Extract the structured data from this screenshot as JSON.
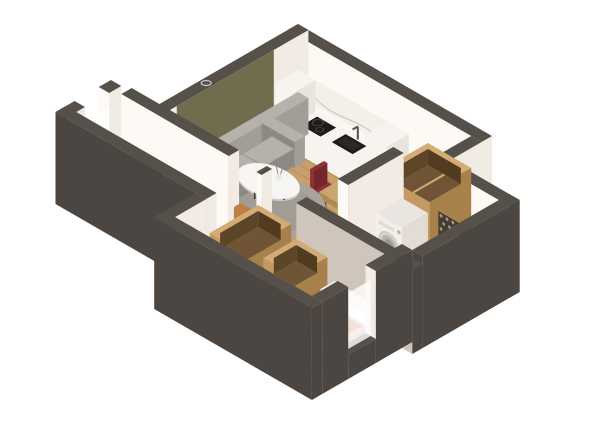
{
  "image": {
    "description": "3D isometric cutaway rendering of a one-bedroom apartment floor plan",
    "view": "isometric",
    "background": "#ffffff"
  },
  "palette": {
    "wallTop": "#56504b",
    "wallOuter": "#4b4641",
    "wallFace": "#f1ebe4",
    "wallFaceBright": "#fdfaf5",
    "wallFaceShade": "#e7dfd5",
    "wallTaupe": "#cfc5ba",
    "olive": "#6f6d4d",
    "oliveShade": "#5d5b40",
    "wood": "#c9a06b",
    "bedroomWood": "#bd9460",
    "plankLine": "rgba(90,60,30,0.18)",
    "hallFloor": "#f4ecdd",
    "bathFloor": "#dfdbd5",
    "tileLine": "rgba(120,110,100,0.25)",
    "rug": "#a8a39d",
    "rugShade": "#948f89",
    "sofa": "#a29e97",
    "sofaLight": "#b6b2ab",
    "sofaShade": "#8d8982",
    "tableWhite": "#f6f5f3",
    "tableEdge": "#cfcac4",
    "legDark": "#3a352f",
    "armchair": "#bf7f44",
    "armchairLight": "#cf9257",
    "armchairDark": "#a86a35",
    "chairRed": "#8e3038",
    "chairRedDark": "#74262d",
    "diningWood": "#cba571",
    "diningWoodSide": "#b08850",
    "cabWood": "#c39a63",
    "cabWoodSide": "#a8804c",
    "cabInterior": "#6f5535",
    "cabRim": "#d3ab75",
    "counter": "#f7f4f0",
    "counterSide": "#eae4dc",
    "appliance": "#1d1c1a",
    "marble": "#f3efe9",
    "marbleVein": "#c9c2b8",
    "mosaic": "#453b31",
    "mosaicDot": "#b3a287",
    "washer": "#f3f0ec",
    "washerSide": "#e2dcd4",
    "drum": "#b8b3ac",
    "drumRing": "#d8d3cc",
    "vanity": "#c79d65",
    "basin": "#fbfaf8",
    "mattress": "#c7c2ba",
    "duvet": "#ddd8d0",
    "pillow": "#f4f1ec",
    "throwOrange": "#d3702c",
    "throwOrangeDark": "#b85f24",
    "mirrorWood": "#c69a62",
    "mirrorRim": "#a67c49",
    "plant": "#4e5a38",
    "plantDark": "#3b4629",
    "shadow": "rgba(60,50,40,0.18)",
    "lanternGlow": "#f2e3c2",
    "windowGlow": "#ffffff"
  },
  "rooms": [
    {
      "id": "living-room",
      "contents": [
        "sofa",
        "rug",
        "coffee-table",
        "vase",
        "armchair",
        "plant",
        "lantern",
        "olive-accent-wall"
      ]
    },
    {
      "id": "kitchen",
      "contents": [
        "tall-cabinet",
        "counter",
        "cooktop",
        "sink",
        "faucet",
        "marble-backsplash",
        "open-wardrobe"
      ]
    },
    {
      "id": "dining-area",
      "contents": [
        "dining-table",
        "chair-red-1",
        "chair-red-2",
        "chair-red-3",
        "chair-red-4"
      ]
    },
    {
      "id": "hallway",
      "contents": [
        "round-mirror-large",
        "round-mirror-small",
        "round-mirror-medium",
        "stool"
      ]
    },
    {
      "id": "corridor",
      "contents": [
        "open-wardrobe-tall",
        "open-wardrobe-low"
      ]
    },
    {
      "id": "bathroom",
      "contents": [
        "washing-machine",
        "mosaic-accent-wall",
        "vanity",
        "basin",
        "toilet"
      ]
    },
    {
      "id": "bedroom",
      "contents": [
        "bed",
        "pillows",
        "orange-throw",
        "duvet",
        "open-wardrobe-1",
        "open-wardrobe-2",
        "window"
      ]
    }
  ]
}
